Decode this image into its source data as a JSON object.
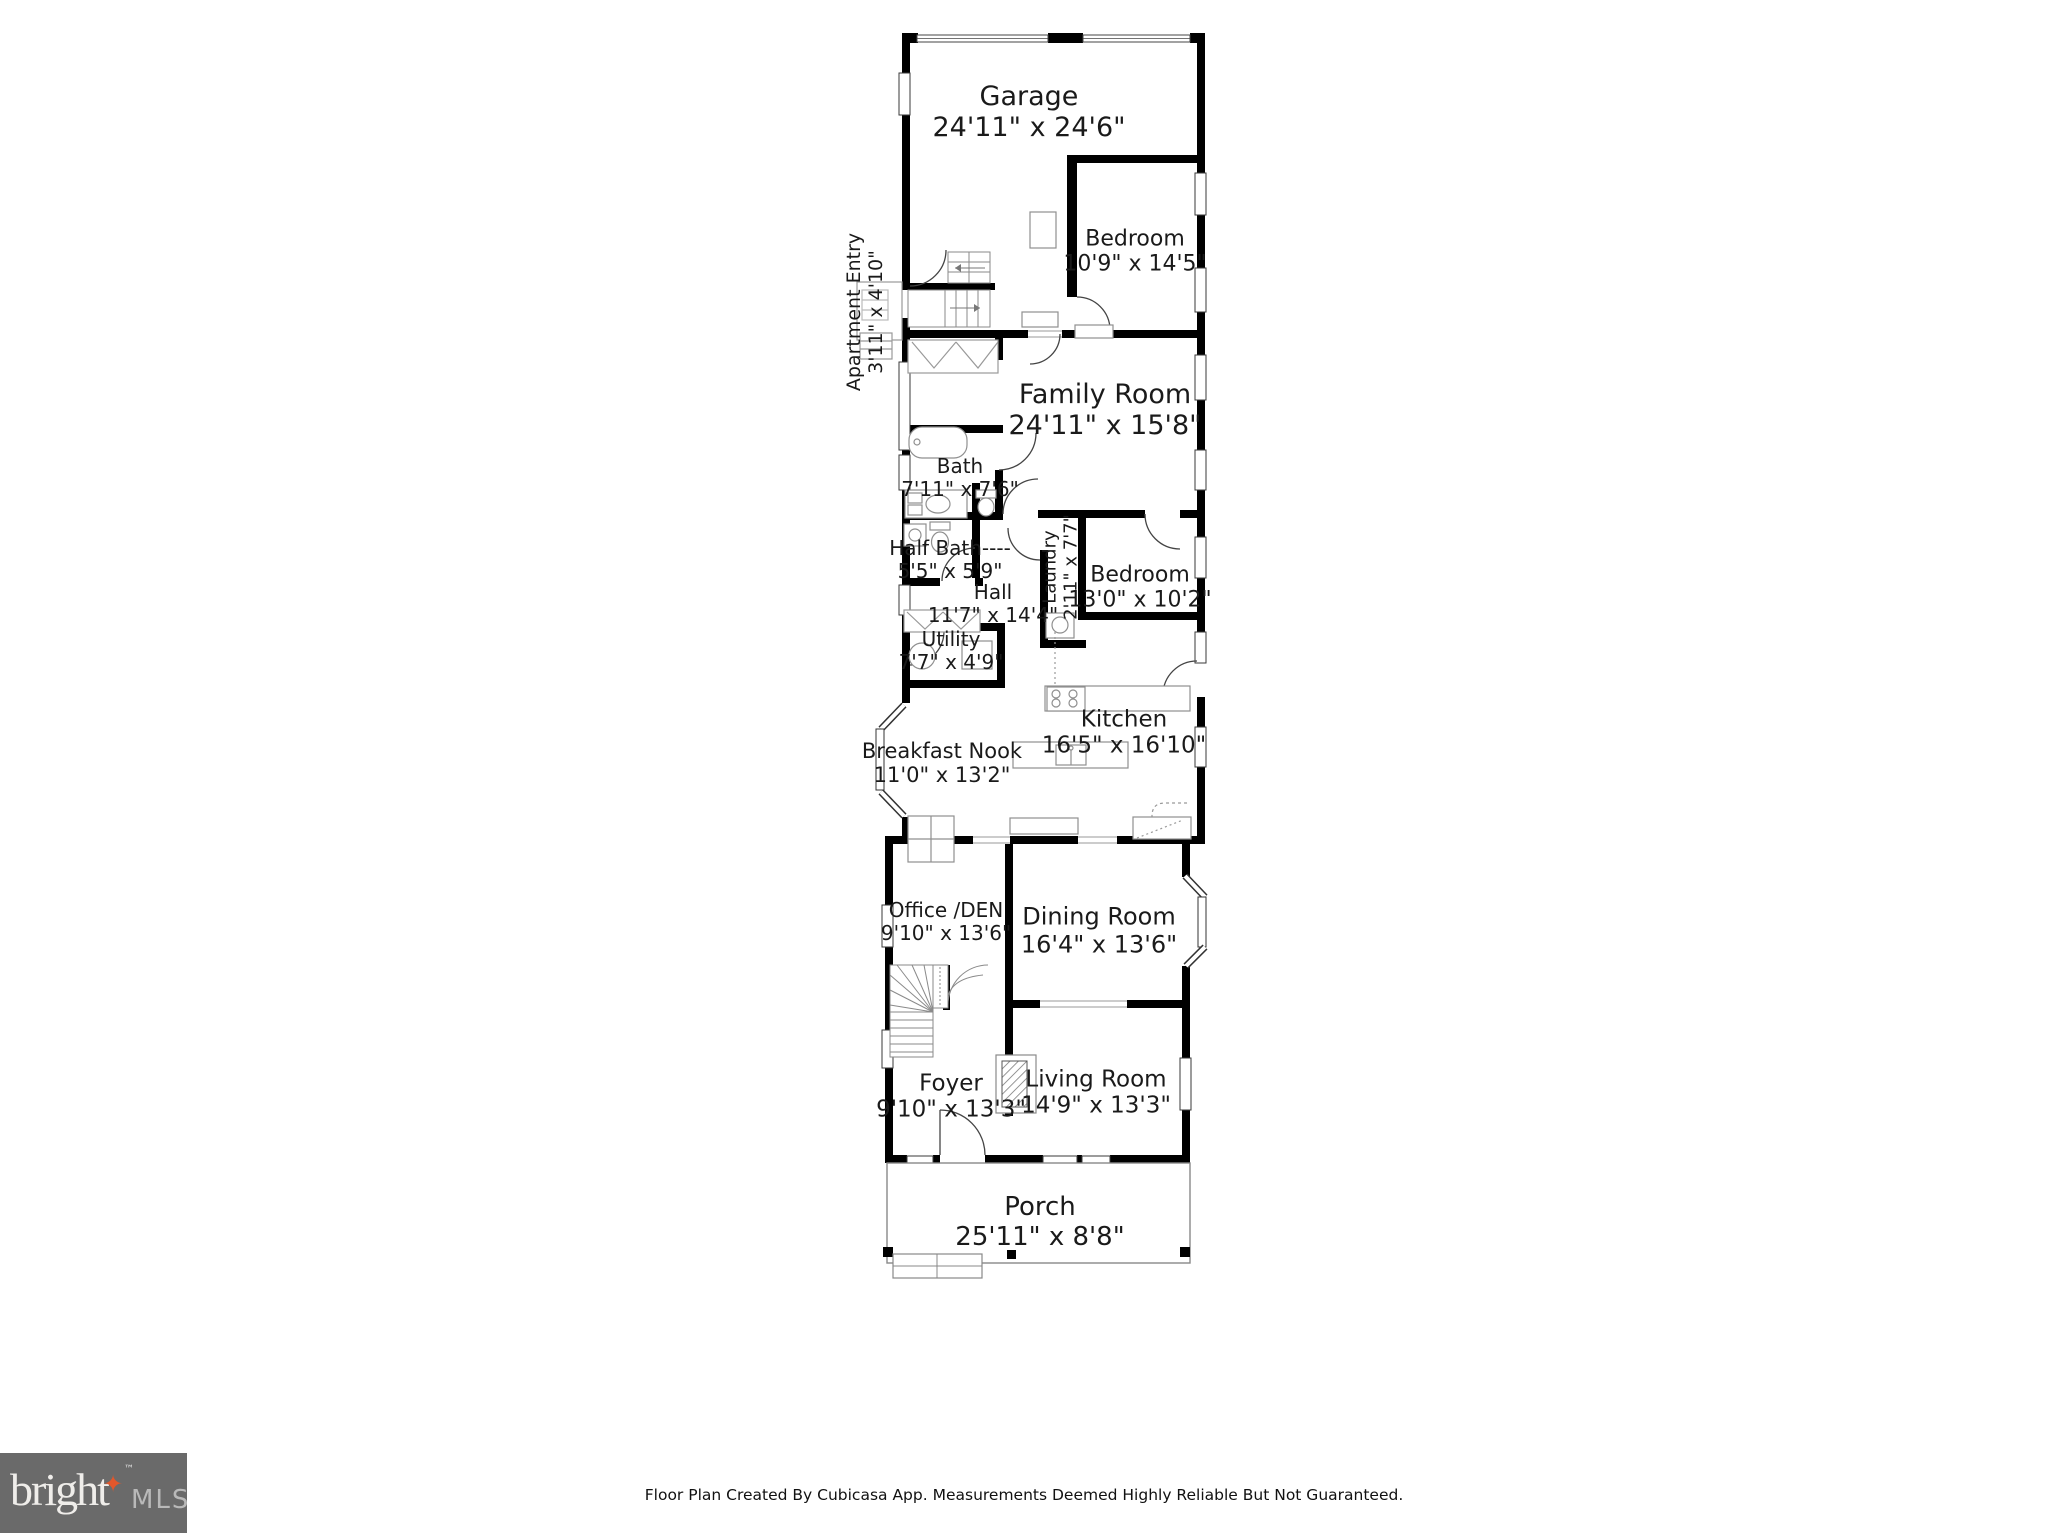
{
  "rooms": {
    "garage": {
      "name": "Garage",
      "dims": "24'11\" x 24'6\""
    },
    "bedroom1": {
      "name": "Bedroom",
      "dims": "10'9\" x 14'5\""
    },
    "apartment_entry": {
      "name": "Apartment Entry",
      "dims": "3'11\" x 4'10\""
    },
    "family_room": {
      "name": "Family Room",
      "dims": "24'11\" x 15'8\""
    },
    "bath": {
      "name": "Bath",
      "dims": "7'11\" x 7'6\""
    },
    "half_bath": {
      "name": "Half Bath----",
      "dims": "5'5\" x 5'9\""
    },
    "hall": {
      "name": "Hall",
      "dims": "11'7\" x 14'4\""
    },
    "laundry": {
      "name": "Laundry",
      "dims": "2'11\" x 7'7\""
    },
    "bedroom2": {
      "name": "Bedroom",
      "dims": "13'0\" x 10'2\""
    },
    "utility": {
      "name": "Utility",
      "dims": "7'7\" x 4'9\""
    },
    "breakfast_nook": {
      "name": "Breakfast Nook",
      "dims": "11'0\" x 13'2\""
    },
    "kitchen": {
      "name": "Kitchen",
      "dims": "16'5\" x 16'10\""
    },
    "office_den": {
      "name": "Office /DEN",
      "dims": "9'10\" x 13'6\""
    },
    "dining_room": {
      "name": "Dining Room",
      "dims": "16'4\" x 13'6\""
    },
    "foyer": {
      "name": "Foyer",
      "dims": "9'10\" x 13'3\""
    },
    "living_room": {
      "name": "Living Room",
      "dims": "14'9\" x 13'3\""
    },
    "porch": {
      "name": "Porch",
      "dims": "25'11\" x 8'8\""
    }
  },
  "footer": {
    "disclaimer": "Floor Plan Created By Cubicasa App. Measurements Deemed Highly Reliable But Not Guaranteed.",
    "logo": {
      "brand": "bright",
      "mls": "MLS",
      "tm": "™",
      "star_glyph": "✦"
    }
  },
  "colors": {
    "wall": "#000000",
    "logo_bg": "#6a6a6a",
    "logo_star": "#e2572b",
    "logo_brand_text": "#efedea",
    "logo_mls_text": "#b9b9b9"
  }
}
